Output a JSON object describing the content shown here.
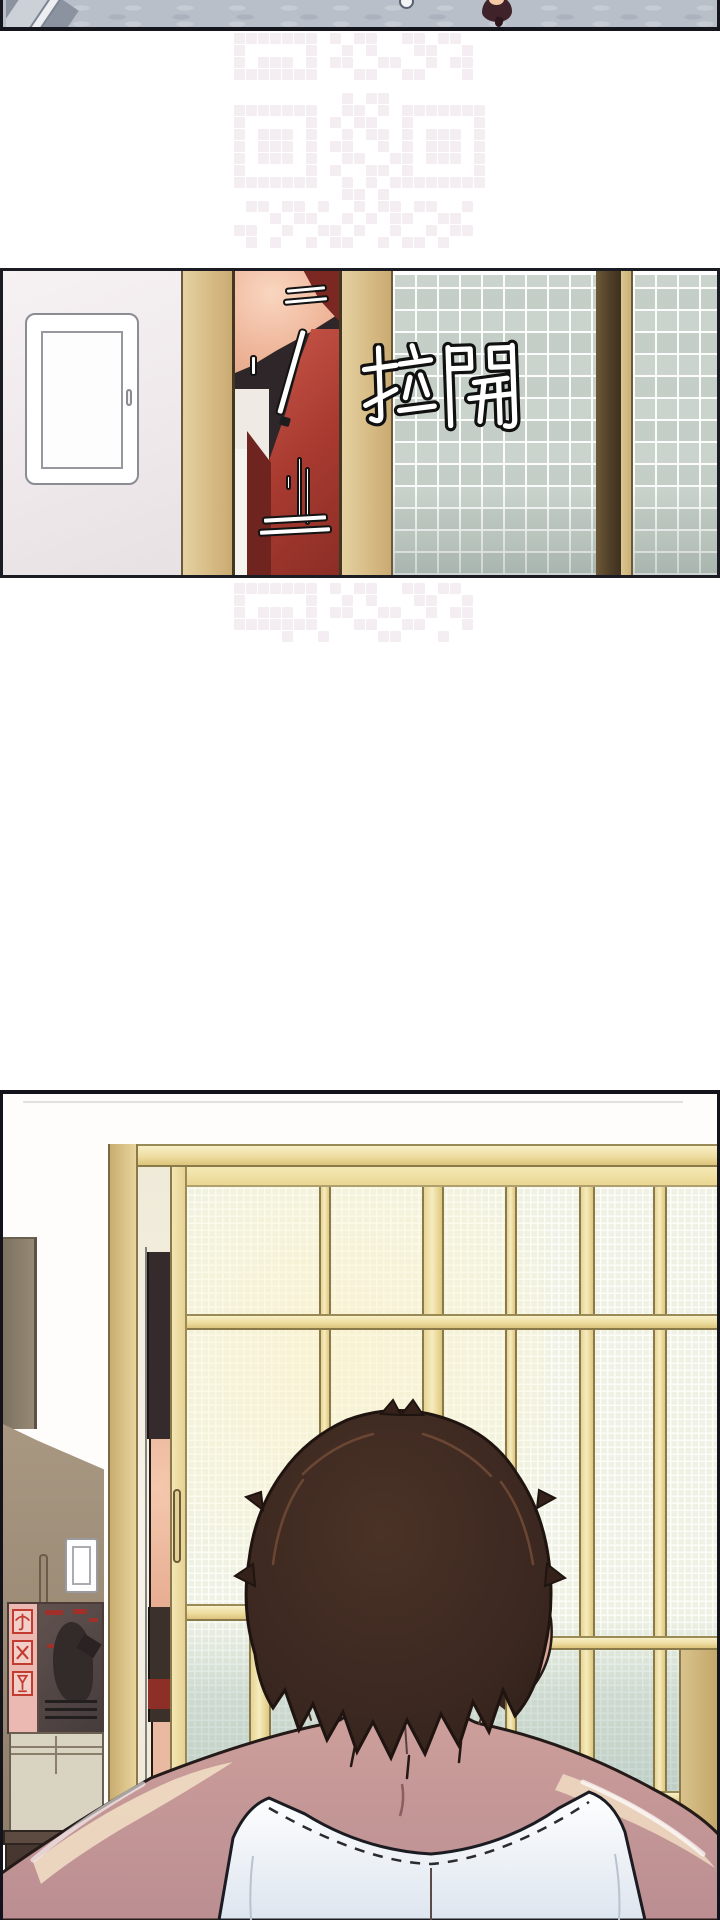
{
  "page": {
    "kind": "webtoon-comic-page",
    "width": 720,
    "height": 1920,
    "background": "#ffffff"
  },
  "panel1": {
    "name": "hallway-floor-closeup",
    "floor_color": "#b9bfc9",
    "objects": [
      "staircase-corner",
      "small-floor-circle",
      "dark-red-shoe"
    ]
  },
  "watermark": {
    "color": "#f2eaee",
    "cell": 12,
    "pattern_top": [
      "111111101011001101100",
      "100000100101000110010",
      "101110101100110010110",
      "111111100011001100010",
      "000000000000000000000",
      "000000000101100000000",
      "111111100110101111111",
      "100000101011001000001",
      "101110100101101011101",
      "101110101100101011101",
      "101110100110011011101",
      "100000101001101000001",
      "111111100101011111111",
      "000000000110100000000",
      "011011010010110110010",
      "000101100101011001100",
      "110010011010010010110",
      "010100101100101101000"
    ],
    "pattern_bottom": [
      "111111101011001101100",
      "100000100101000110010",
      "101110101100110010110",
      "111111100011001100010",
      "000010010000110001000"
    ]
  },
  "panel2": {
    "name": "woman-in-red-overalls-behind-door",
    "sfx": {
      "text": "拉開"
    },
    "colors": {
      "wall": "#f2eef0",
      "frame_tan": "#d6ba83",
      "opening_shadow": "#2e2628",
      "skin": "#efb79b",
      "overalls_red": "#a83a30",
      "hair_red": "#7b2722",
      "shoji_cell": "#cdd6cf",
      "divider_brown": "#4e3d26"
    }
  },
  "panel3": {
    "name": "man-back-of-head-facing-shoji-doors",
    "colors": {
      "frame_yellow": "#f6ecbe",
      "grid_bg": "#eef1e4",
      "grid_teal_tint": "#608a86",
      "hair_brown": "#33211a",
      "skin": "#c79a98",
      "skin_highlight": "#f2e0c6",
      "tank_top": "#ffffff",
      "wardrobe": "#a89781",
      "dresser": "#463830",
      "box_pink": "#ecb9b2",
      "box_mark_red": "#c23b30",
      "box_dark": "#5c504e",
      "box_beige": "#d9d3c1"
    },
    "fragile_icons": [
      "umbrella",
      "cross",
      "wine-glass"
    ]
  }
}
